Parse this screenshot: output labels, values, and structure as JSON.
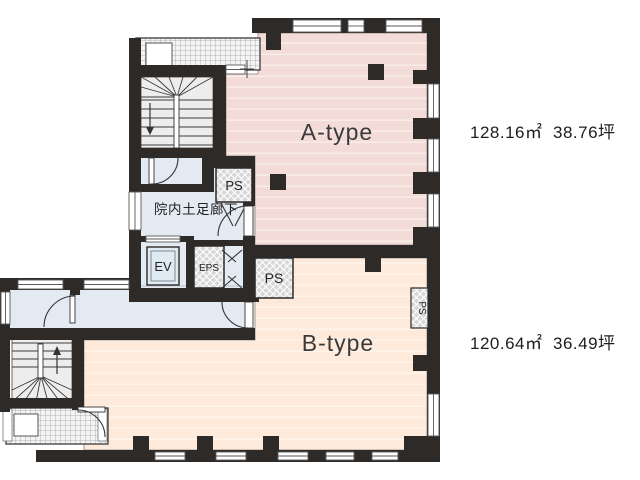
{
  "plan": {
    "title": "floor-plan",
    "unit_a": {
      "label": "A-type",
      "area_sqm": "128.16㎡",
      "area_tsubo": "38.76坪"
    },
    "unit_b": {
      "label": "B-type",
      "area_sqm": "120.64㎡",
      "area_tsubo": "36.49坪"
    },
    "rooms": {
      "corridor_label": "院内土足廊下",
      "elevator_label": "EV",
      "eps_label": "EPS",
      "ps_label_top": "PS",
      "ps_label_mid": "PS",
      "ps_label_right": "PS"
    },
    "colors": {
      "unit_a_fill": "#f3dcd8",
      "unit_b_fill": "#fdeadb",
      "common_fill": "#e4eaf1",
      "wall": "#2d2a28",
      "shaft_hatch": "#d7d7d7"
    }
  }
}
